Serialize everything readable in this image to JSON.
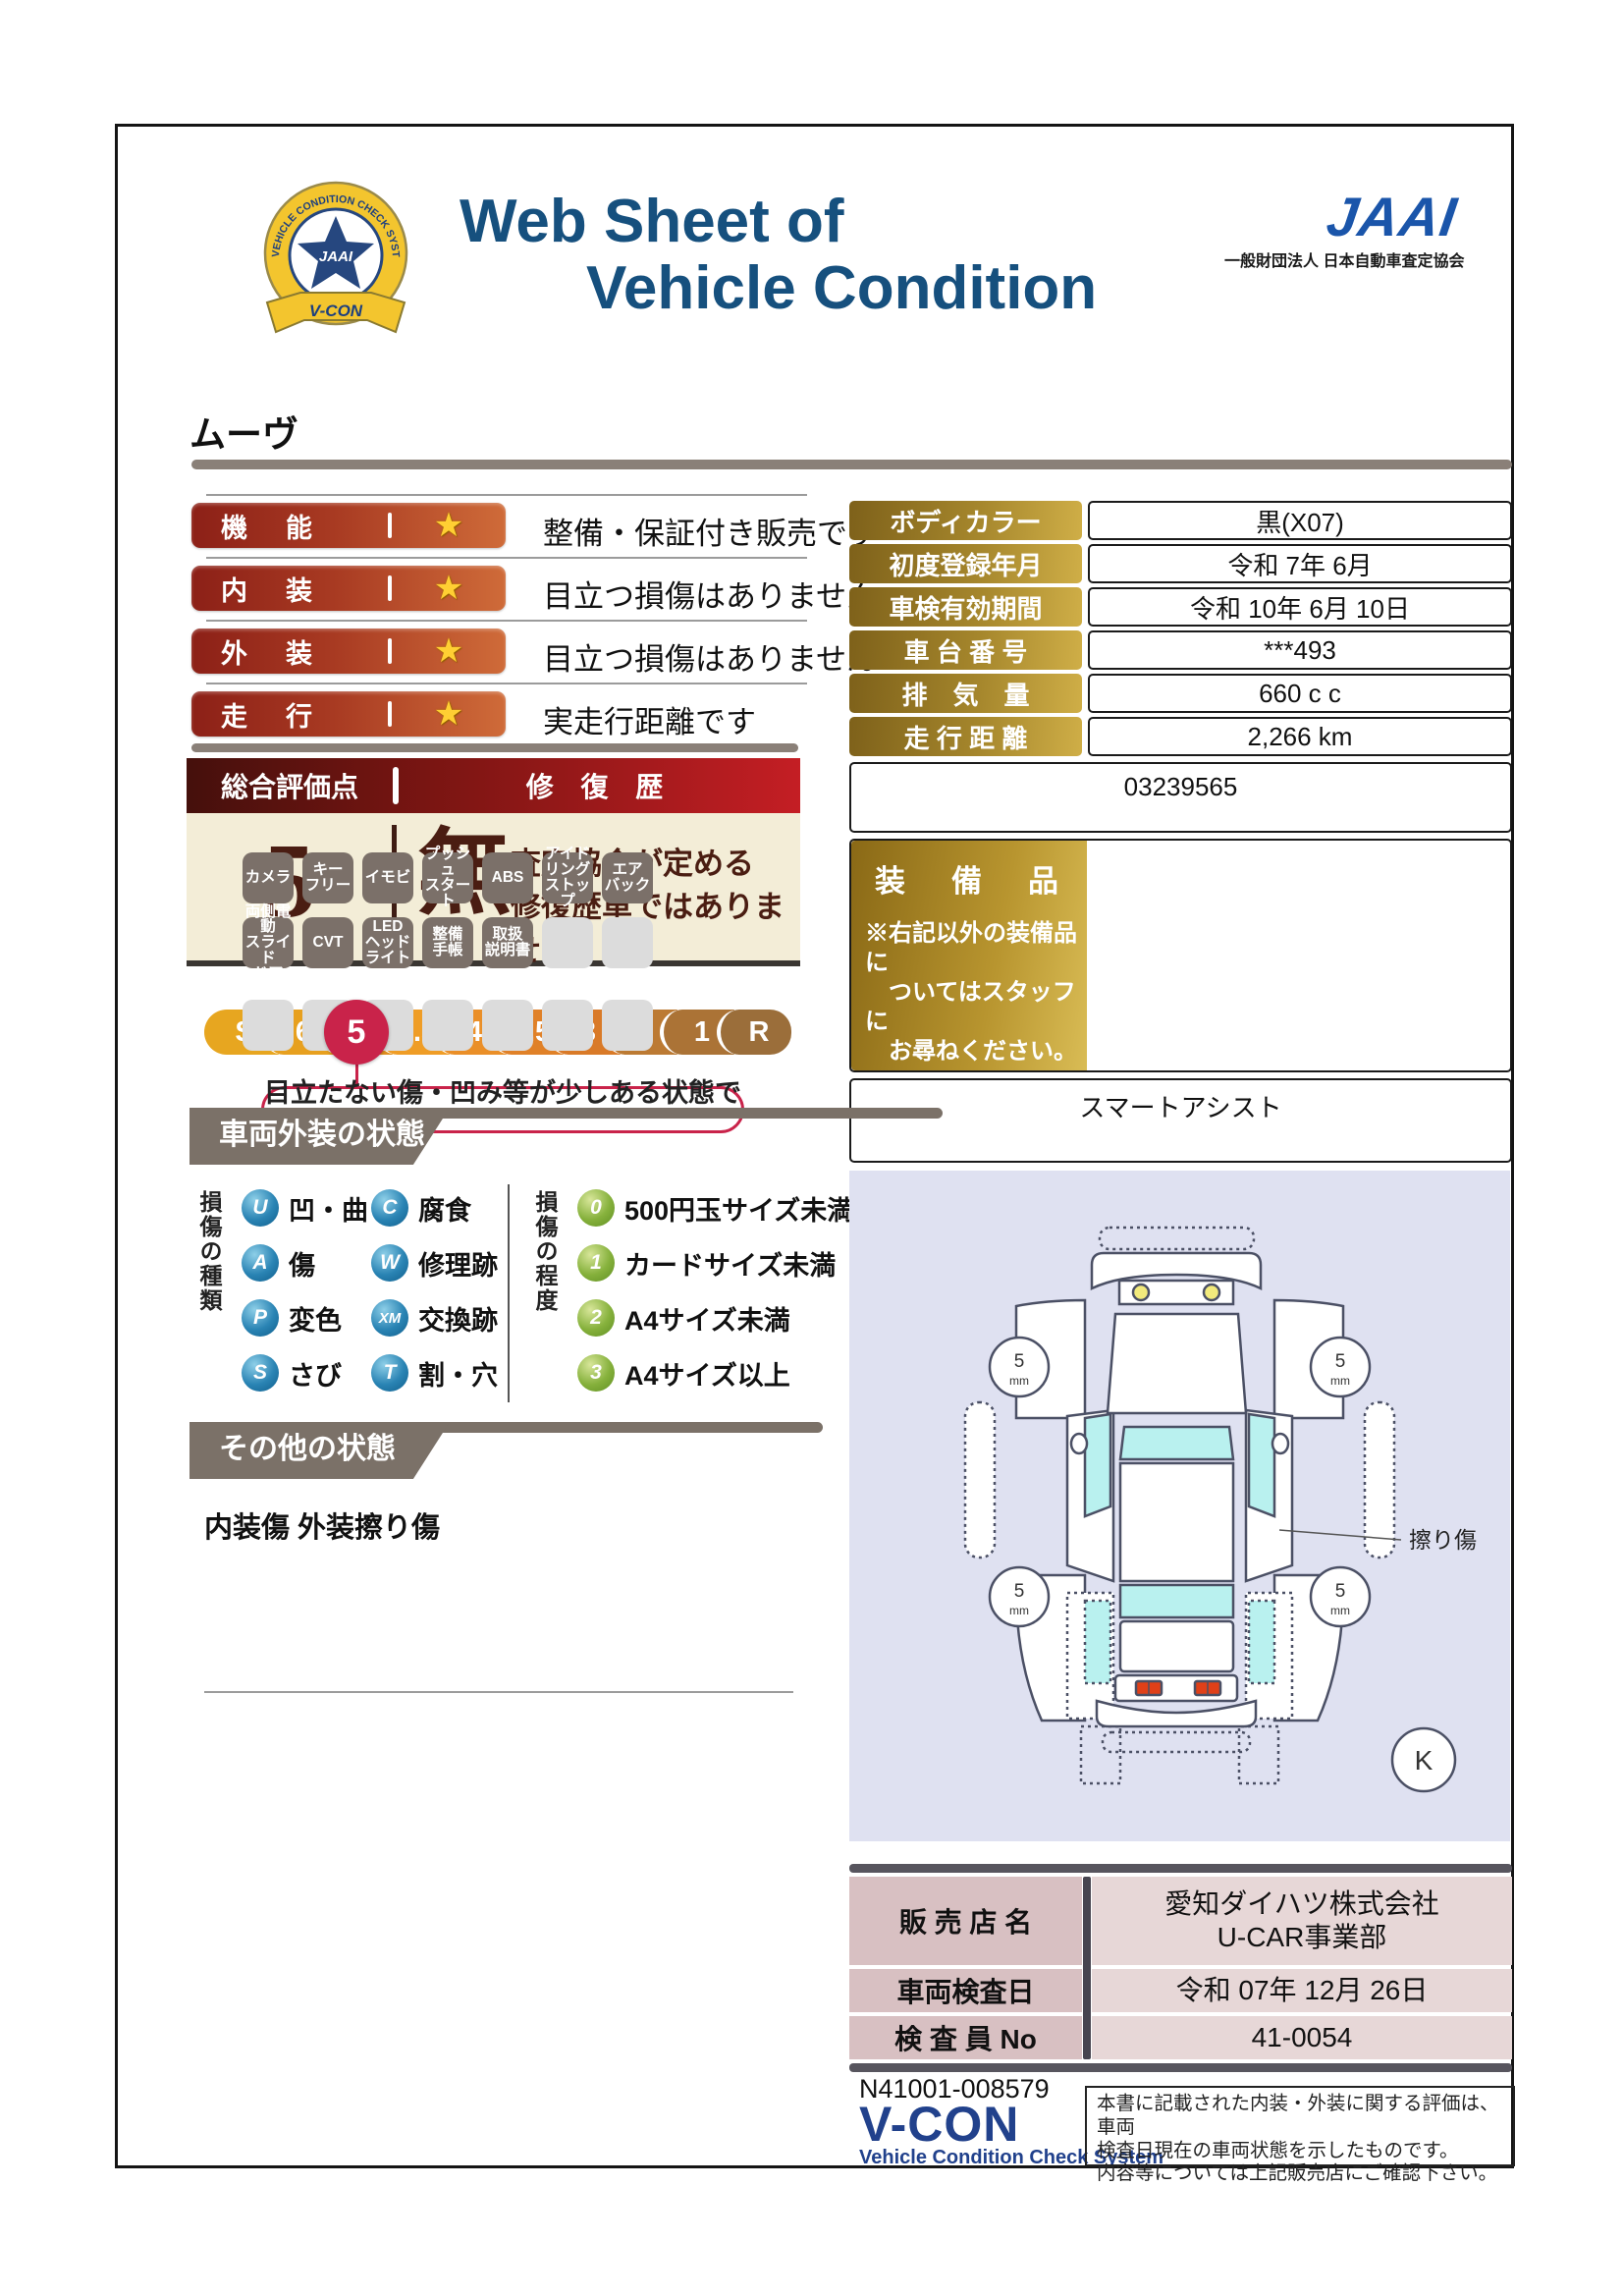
{
  "header": {
    "title_line1": "Web Sheet of",
    "title_line2": "Vehicle Condition",
    "jaai_word": "JAAI",
    "jaai_org": "一般財団法人 日本自動車査定協会",
    "emblem": {
      "top_text": "VEHICLE CONDITION CHECK SYSTEM",
      "center": "JAAI",
      "ribbon": "V-CON"
    }
  },
  "vehicle_name": "ムーヴ",
  "ratings": [
    {
      "label": "機　能",
      "star": "★",
      "comment": "整備・保証付き販売です"
    },
    {
      "label": "内　装",
      "star": "★",
      "comment": "目立つ損傷はありません"
    },
    {
      "label": "外　装",
      "star": "★",
      "comment": "目立つ損傷はありません"
    },
    {
      "label": "走　行",
      "star": "★",
      "comment": "実走行距離です"
    }
  ],
  "overall": {
    "header_left": "総合評価点",
    "header_right": "修 復 歴",
    "score": "5",
    "repair_mark": "無",
    "repair_text1": "査定協会が定める",
    "repair_text2": "修復歴車ではありません",
    "scale": [
      "S",
      "6",
      "5",
      "4.5",
      "4",
      "3.5",
      "3",
      "2",
      "1",
      "R"
    ],
    "selected": "5",
    "scale_note": "目立たない傷・凹み等が少しある状態です"
  },
  "details": {
    "rows": [
      {
        "label": "ボディカラー",
        "value": "黒(X07)"
      },
      {
        "label": "初度登録年月",
        "value": "令和 7年 6月"
      },
      {
        "label": "車検有効期間",
        "value": "令和 10年 6月 10日"
      },
      {
        "label": "車 台 番 号",
        "value": "***493"
      },
      {
        "label": "排　気　量",
        "value": "660 c c"
      },
      {
        "label": "走 行 距 離",
        "value": "2,266 km"
      }
    ],
    "serial": "03239565"
  },
  "equipment": {
    "label": "装　備　品",
    "note": "※右記以外の装備品に\n　ついてはスタッフに\n　お尋ねください。",
    "badges": [
      "カメラ",
      "キー\nフリー",
      "イモビ",
      "プッシュ\nスタート",
      "ABS",
      "アイド\nリング\nストップ",
      "エア\nバック",
      "両側電動\nスライド\nドア",
      "CVT",
      "LED\nヘッド\nライト",
      "整備\n手帳",
      "取扱\n説明書"
    ],
    "footer": "スマートアシスト"
  },
  "legend": {
    "title": "車両外装の状態",
    "kind_label": "損傷の種類",
    "kinds": [
      {
        "code": "U",
        "text": "凹・曲"
      },
      {
        "code": "A",
        "text": "傷"
      },
      {
        "code": "P",
        "text": "変色"
      },
      {
        "code": "S",
        "text": "さび"
      },
      {
        "code": "C",
        "text": "腐食"
      },
      {
        "code": "W",
        "text": "修理跡"
      },
      {
        "code": "XM",
        "text": "交換跡"
      },
      {
        "code": "T",
        "text": "割・穴"
      }
    ],
    "degree_label": "損傷の程度",
    "degrees": [
      {
        "code": "0",
        "text": "500円玉サイズ未満"
      },
      {
        "code": "1",
        "text": "カードサイズ未満"
      },
      {
        "code": "2",
        "text": "A4サイズ未満"
      },
      {
        "code": "3",
        "text": "A4サイズ以上"
      }
    ]
  },
  "other": {
    "title": "その他の状態",
    "text": "内装傷 外装擦り傷"
  },
  "diagram": {
    "tire_value": "5",
    "tire_unit": "mm",
    "annotation": "擦り傷",
    "mark": "K"
  },
  "dealer": {
    "rows": [
      {
        "label": "販 売 店 名",
        "value": "愛知ダイハツ株式会社\nU-CAR事業部"
      },
      {
        "label": "車両検査日",
        "value": "令和 07年 12月 26日"
      },
      {
        "label": "検 査 員 No",
        "value": "41-0054"
      }
    ]
  },
  "footer": {
    "serial": "N41001-008579",
    "logo": "V-CON",
    "logo_sub": "Vehicle Condition Check System",
    "disclaimer": "本書に記載された内装・外装に関する評価は、車両\n検査日現在の車両状態を示したものです。\n内容等については上記販売店にご確認下さい。"
  },
  "colors": {
    "accent_red": "#c9234a",
    "maroon": "#8c2017",
    "gold_dark": "#8a6916",
    "gold_light": "#d9bc55",
    "navy_title": "#16507e",
    "jaai_blue": "#1a55aa",
    "banner_gray": "#7b7168",
    "badge_gray": "#7b7069",
    "cream": "#f3edd7",
    "diagram_bg": "#dfe1f1",
    "glass_cyan": "#b9f1ef"
  }
}
